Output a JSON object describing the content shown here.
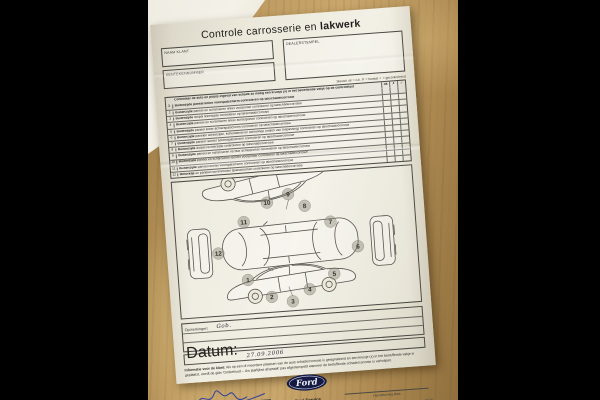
{
  "document": {
    "title_regular": "Controle carrosserie en ",
    "title_bold": "lakwerk",
    "fields": {
      "naam_klant": "NAAM KLANT",
      "kenteken": "KENTEKENNUMMER",
      "dealerstempel": "DEALERSTEMPEL"
    },
    "legend": "Sleutel: ok = o.k.    ✗ = herstel    ✓ = gecontroleerd",
    "checklist": {
      "header": "Controleer de auto en plaats ingeval van schade zo nodig een kruisje (x) in het betreffende vakje op de controlelijst",
      "check_columns": [
        "ok",
        "✗",
        "✓"
      ],
      "rows": [
        {
          "num": "1",
          "bold": "Buitenzijde",
          "text": " paneel linker voorspatscherm controleren op lakschade/corrosie"
        },
        {
          "num": "2",
          "bold": "Buitenzijde",
          "text": " paneel en scharnieren linker voorportier controleren op lakschade/corrosie"
        },
        {
          "num": "3",
          "bold": "Buitenzijde",
          "text": " dorpel linkerzijde controleren op lakschade/corrosie"
        },
        {
          "num": "4",
          "bold": "Buitenzijde",
          "text": " paneel en scharnieren linker achterportier controleren op lakschade/corrosie"
        },
        {
          "num": "5",
          "bold": "Buitenzijde",
          "text": " paneel linker achterspatscherm controleren op lakschade/corrosie"
        },
        {
          "num": "6",
          "bold": "Buitenzijde",
          "text": " panelen achterzijde, kofferdeksel en achterklep (indien van toepassing) controleren op lakschade/corrosie"
        },
        {
          "num": "7",
          "bold": "Buitenzijde",
          "text": " paneel rechter achterspatscherm controleren op lakschade/corrosie"
        },
        {
          "num": "8",
          "bold": "Buitenzijde",
          "text": " dorpel rechterzijde controleren op lakschade/corrosie"
        },
        {
          "num": "9",
          "bold": "Buitenzijde",
          "text": " paneel en scharnieren rechter achterportier controleren op lakschade/corrosie"
        },
        {
          "num": "10",
          "bold": "Buitenzijde",
          "text": " paneel en scharnieren rechter voorportier controleren op lakschade/corrosie"
        },
        {
          "num": "11",
          "bold": "Buitenzijde",
          "text": " paneel rechter voorspatscherm controleren op lakschade/corrosie"
        },
        {
          "num": "12",
          "bold": "Motorkap",
          "text": " en panelen boven/onder spatschermen controleren op lakschade/corrosie"
        }
      ]
    },
    "diagram": {
      "numbers": [
        "1",
        "2",
        "3",
        "4",
        "5",
        "6",
        "7",
        "8",
        "9",
        "10",
        "11",
        "12"
      ]
    },
    "opmerkingen_label": "Opmerkingen:",
    "opmerkingen_value": "Gob.",
    "datum_label": "Datum:",
    "datum_value": "27.09.2006",
    "info": {
      "lead": "Informatie voor de klant:",
      "text": " Als op een of meerdere plaatsen van de auto schade/corrosie is gesignaleerd en een kruisje (x) in het betreffende vakje is geplaatst, wordt de gids 'Onderhoud – Uw jaarlijkse afspraak' pas afgestempeld wanneer de betreffende schade/corrosie is verholpen."
    },
    "signatures": {
      "advisor": "Handtekening service-adviseur",
      "client": "Handtekening klant"
    },
    "logo": {
      "oval_text": "Ford",
      "service_regular": "Ford ",
      "service_bold": "Service"
    },
    "codes": {
      "left": "5102",
      "right": "193 blz"
    }
  },
  "colors": {
    "wood": "#bd9a60",
    "paper": "#ece9db",
    "ford_navy": "#141a42",
    "signature_blue": "#2f3f9e",
    "ink": "#23221f"
  }
}
